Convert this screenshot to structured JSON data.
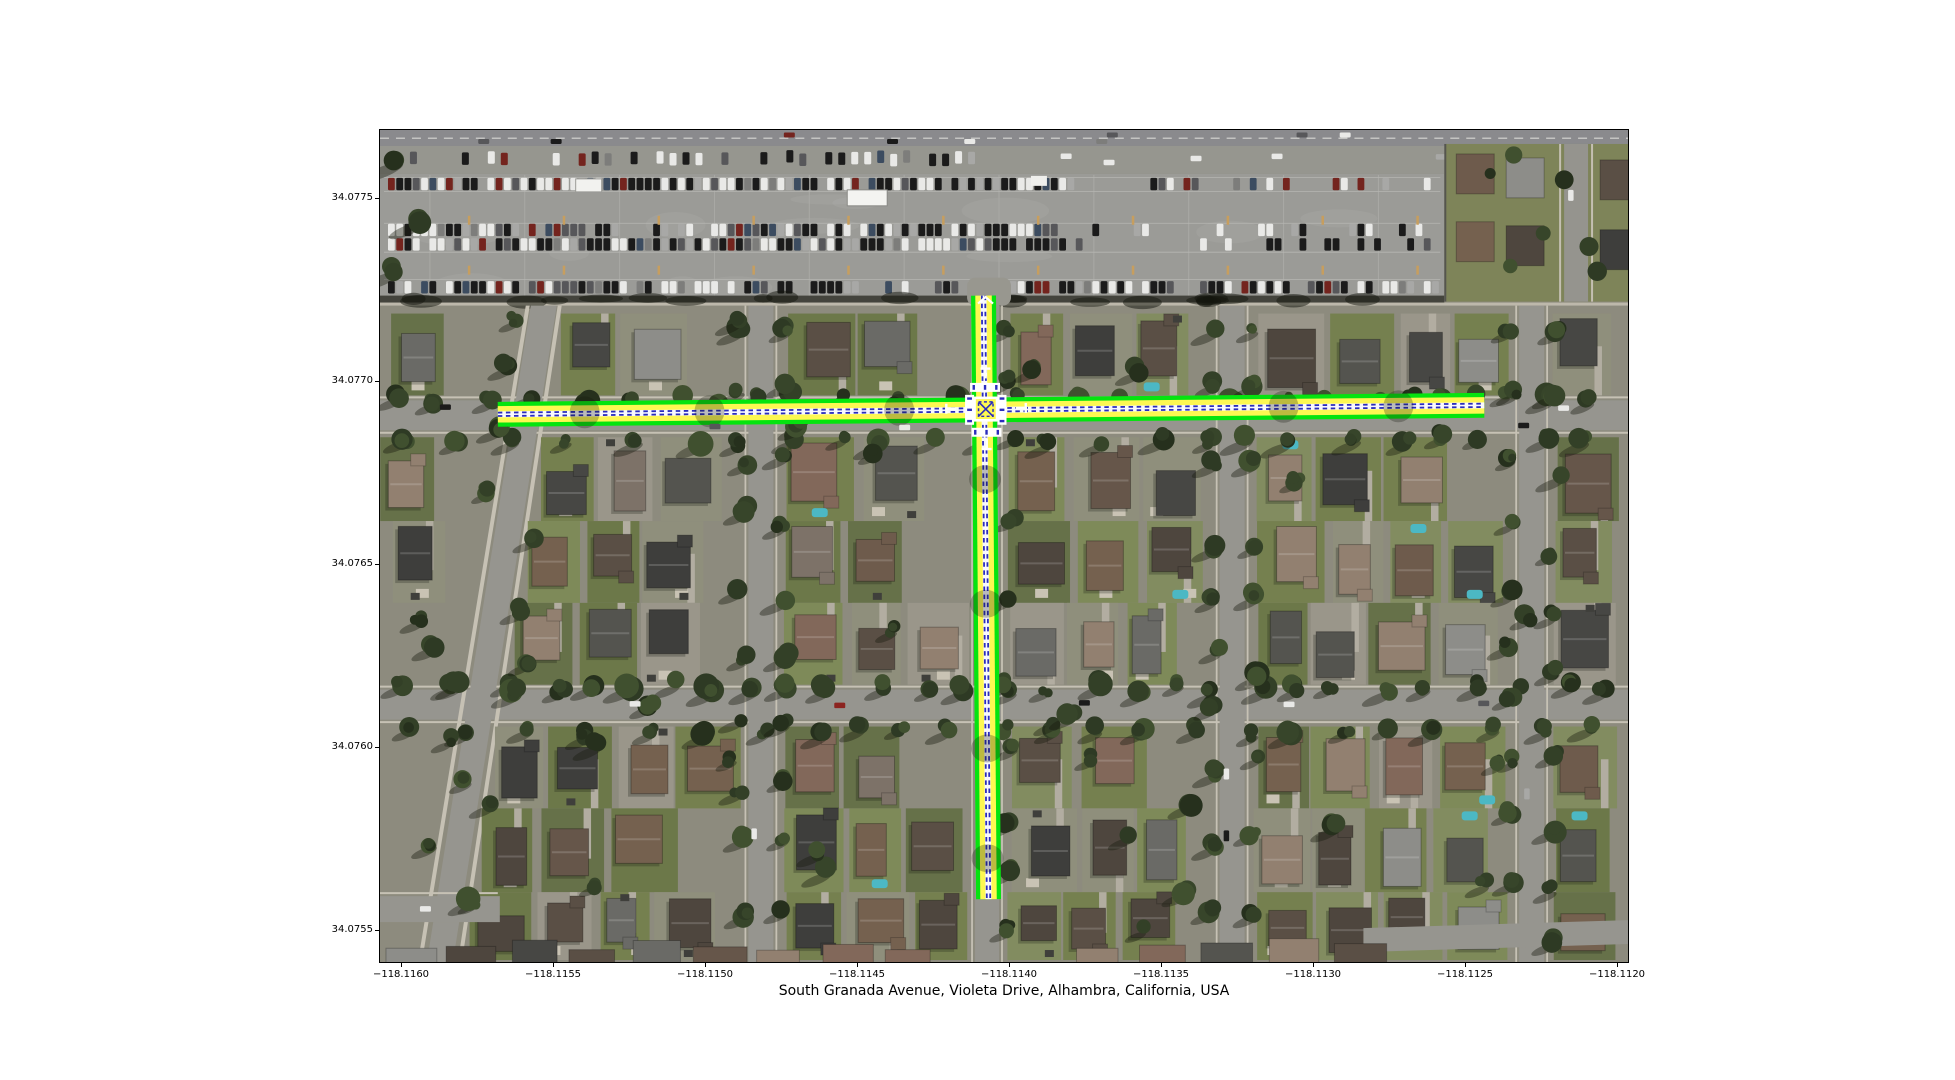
{
  "figure": {
    "xlabel": "South Granada Avenue, Violeta Drive, Alhambra, California, USA",
    "x_ticks": [
      "−118.1160",
      "−118.1155",
      "−118.1150",
      "−118.1145",
      "−118.1140",
      "−118.1135",
      "−118.1130",
      "−118.1125",
      "−118.1120"
    ],
    "y_ticks": [
      "34.0775",
      "34.0770",
      "34.0765",
      "34.0760",
      "34.0755"
    ],
    "axis_color": "#000000",
    "background_color": "#ffffff"
  },
  "map": {
    "type": "satellite-aerial-with-route-overlay",
    "streets_highlighted": [
      "South Granada Avenue",
      "Violeta Drive"
    ],
    "city": "Alhambra",
    "state": "California",
    "country": "USA",
    "lon_range": [
      -118.1161,
      -118.112
    ],
    "lat_range": [
      34.0754,
      34.0777
    ],
    "intersection": {
      "lon": -118.1141,
      "lat": 34.077
    },
    "highlight": {
      "edge_color": "#05e40f",
      "fill_color": "#fdf852",
      "centerline_color": "#2a2cbd",
      "crosswalk_color": "#ffffff"
    }
  }
}
